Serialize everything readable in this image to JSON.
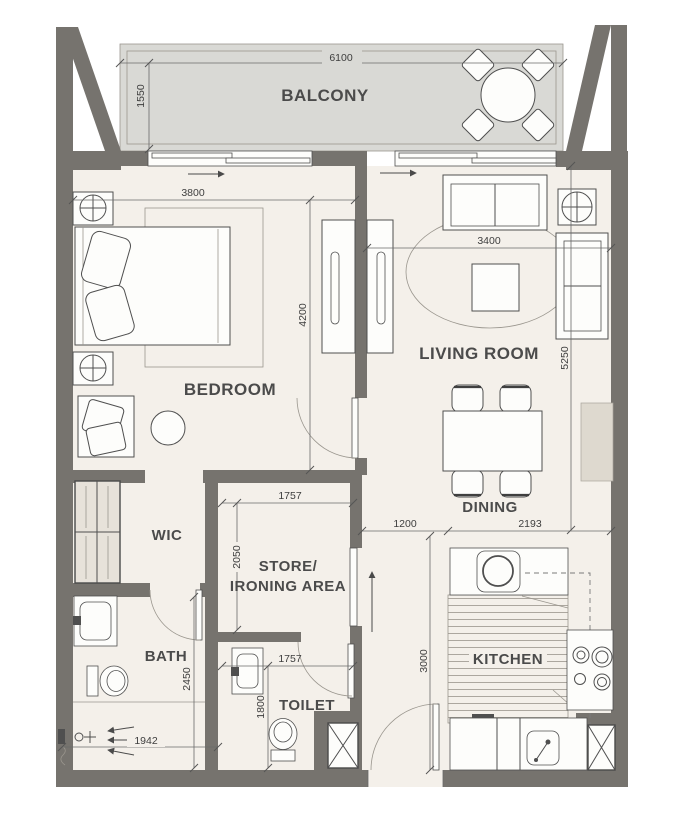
{
  "meta": {
    "type": "apartment-floor-plan"
  },
  "colors": {
    "wall": "#76736e",
    "floor": "#f4f0ea",
    "balcony": "#d9d9d5",
    "line": "#4f4f4f",
    "cabinet": "#ded9cf",
    "wardrobe": "#e7e2da"
  },
  "rooms": {
    "balcony": {
      "label": "BALCONY"
    },
    "bedroom": {
      "label": "BEDROOM"
    },
    "living": {
      "label": "LIVING ROOM"
    },
    "dining": {
      "label": "DINING"
    },
    "wic": {
      "label": "WIC"
    },
    "store": {
      "label_line1": "STORE/",
      "label_line2": "IRONING AREA"
    },
    "bath": {
      "label": "BATH"
    },
    "toilet": {
      "label": "TOILET"
    },
    "kitchen": {
      "label": "KITCHEN"
    }
  },
  "dims": {
    "balcony_width": "6100",
    "balcony_depth": "1550",
    "bedroom_width": "3800",
    "bedroom_depth": "4200",
    "living_width": "3400",
    "living_depth": "5250",
    "hall_width": "1200",
    "kitchen_width": "2193",
    "kitchen_depth": "3000",
    "store_width": "1757",
    "store_depth": "2050",
    "bath_depth": "2450",
    "shower_width": "1942",
    "toilet_width": "1757",
    "toilet_depth": "1800"
  }
}
